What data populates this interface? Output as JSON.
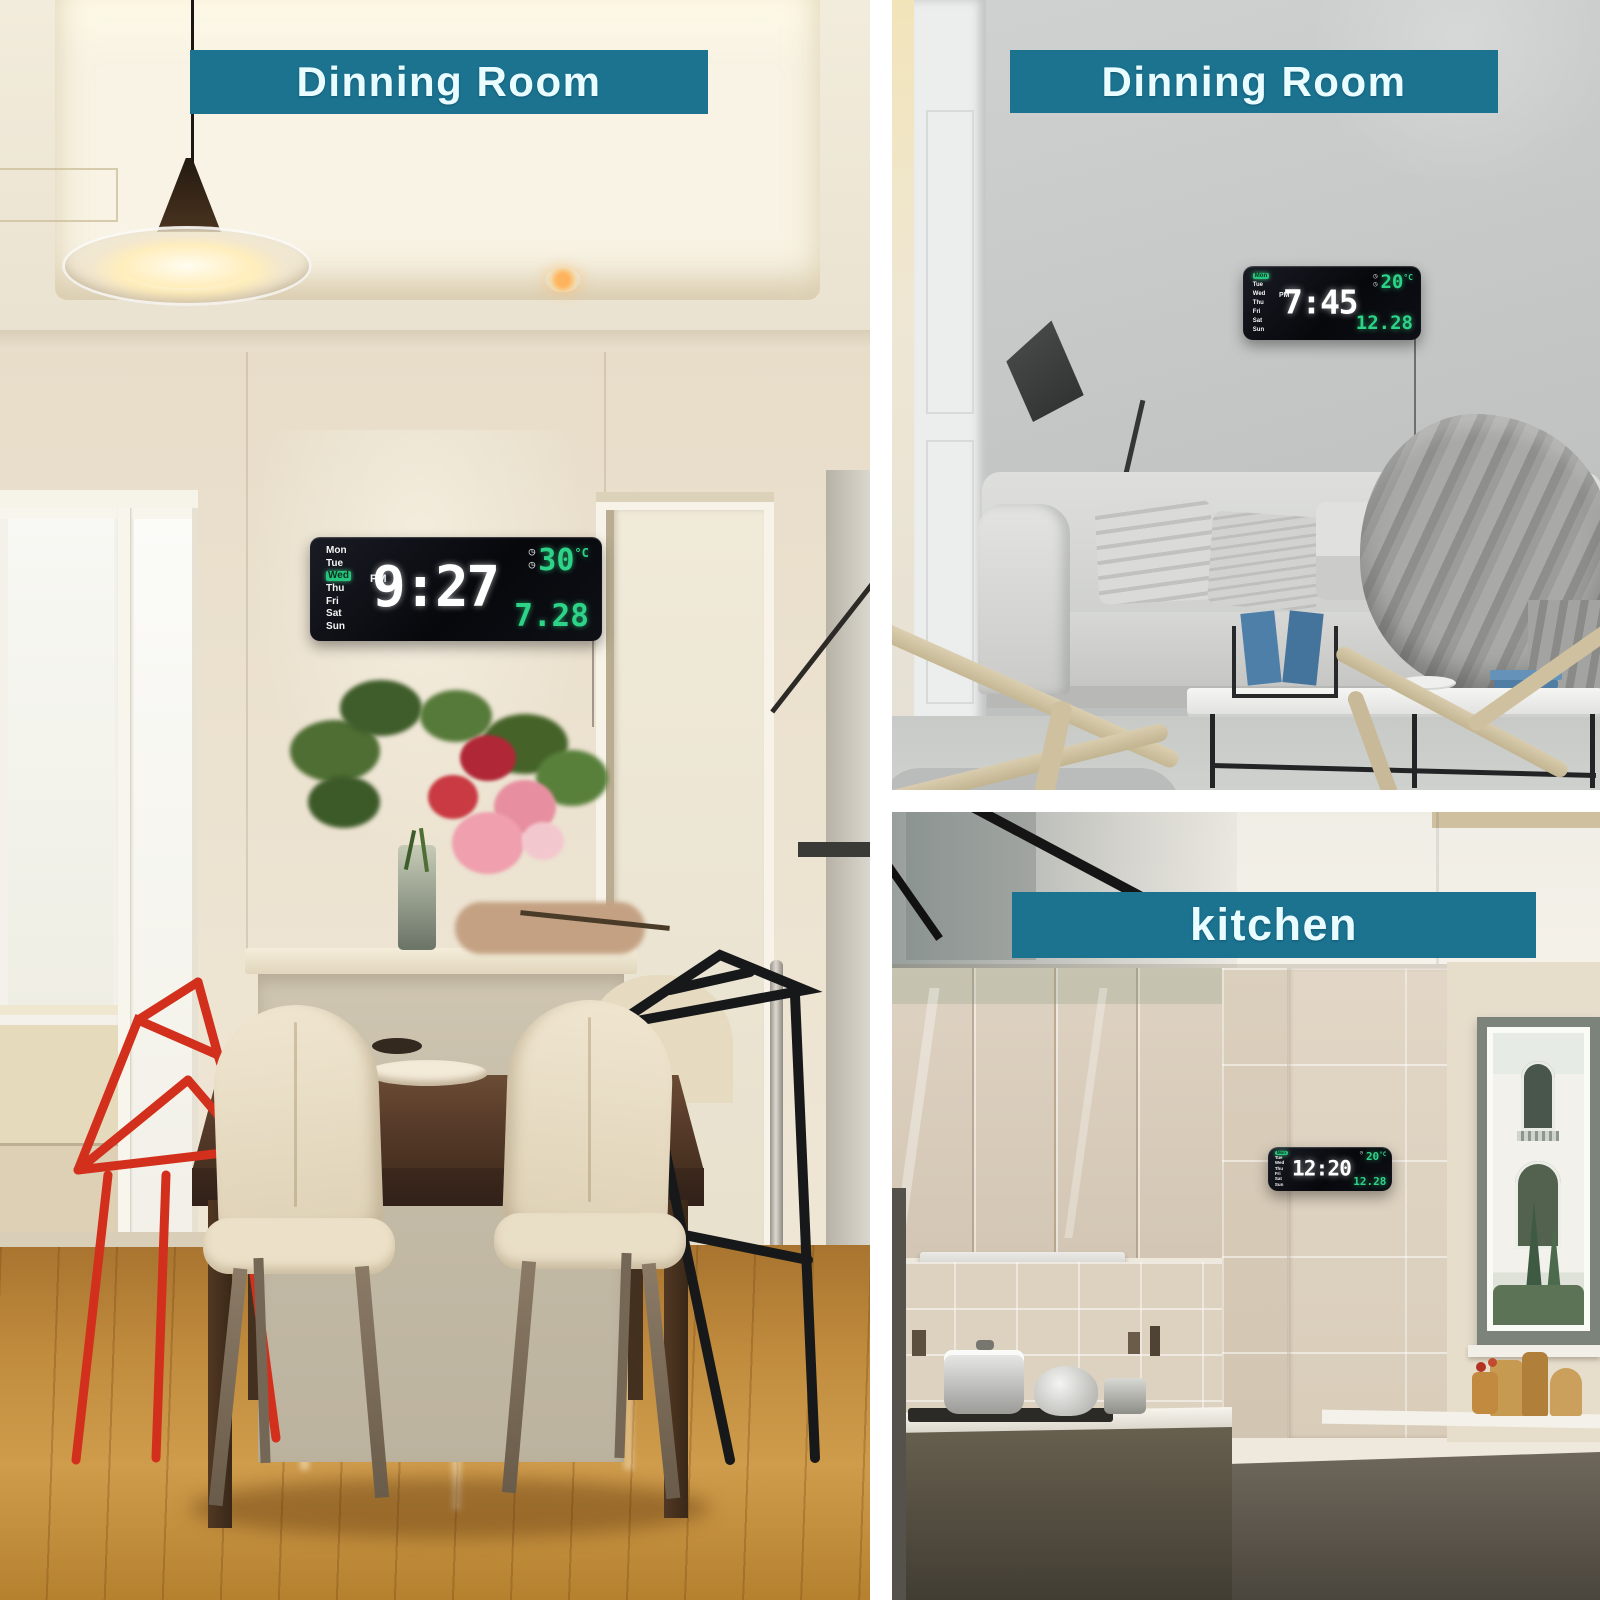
{
  "page": {
    "description": "Three-photo product collage showing a rectangular LED digital wall clock in different rooms"
  },
  "panels": {
    "dining": {
      "banner_label": "Dinning Room"
    },
    "living": {
      "banner_label": "Dinning Room"
    },
    "kitchen": {
      "banner_label": "kitchen"
    }
  },
  "days": [
    "Mon",
    "Tue",
    "Wed",
    "Thu",
    "Fri",
    "Sat",
    "Sun"
  ],
  "icons": {
    "alarm": "◷"
  },
  "clocks": {
    "dining": {
      "time": "9:27",
      "period": "PM",
      "temperature": "30",
      "temp_unit": "°C",
      "date": "7.28",
      "active_day": "Wed"
    },
    "living": {
      "time": "7:45",
      "period": "PM",
      "temperature": "20",
      "temp_unit": "°C",
      "date": "12.28",
      "active_day": "Mon"
    },
    "kitchen": {
      "time": "12:20",
      "temperature": "20",
      "temp_unit": "°C",
      "date": "12.28",
      "active_day": "Mon"
    }
  },
  "colors": {
    "banner_teal": "#1b7390",
    "led_green": "#2dd488",
    "led_white": "#ffffff",
    "clock_body": "#0a0b10",
    "red_chair": "#d2301c",
    "wood_floor": "#c08b3d"
  }
}
